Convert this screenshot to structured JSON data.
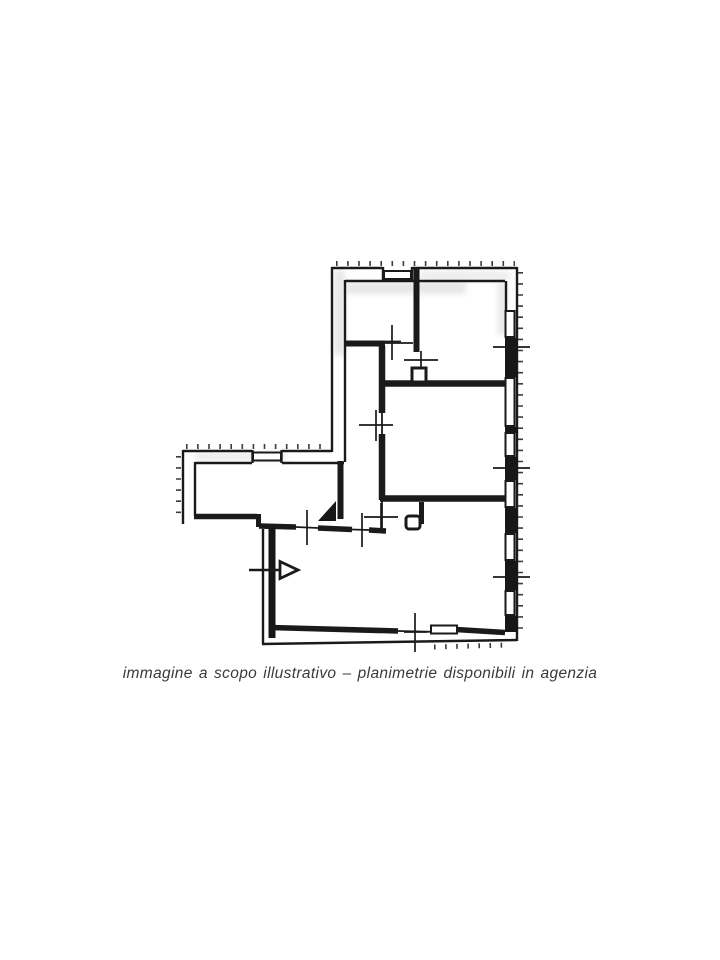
{
  "page": {
    "background": "#ffffff",
    "width": 720,
    "height": 960
  },
  "floor_plan": {
    "kind": "scanned apartment floor plan (planimetria)",
    "ink_color": "#1a1a1a",
    "paper_color": "#ffffff",
    "scan_shadow_color": "#b0b0b0",
    "features": {
      "windows_right_wall_count": 6,
      "window_top_wall_count": 1,
      "window_wing_wall_count": 1,
      "window_bottom_wall_count": 1,
      "measure_tick_marks_count": 10,
      "entrance_arrow": "open triangle arrow pointing right through lower-left wall",
      "filled_corner_triangle": "solid black triangle at corridor / lower room junction",
      "hatching": "short tick hatching along outside of exterior walls"
    }
  },
  "caption": {
    "text": "immagine a scopo illustrativo – planimetrie disponibili in agenzia",
    "color": "#3a3a3a"
  }
}
